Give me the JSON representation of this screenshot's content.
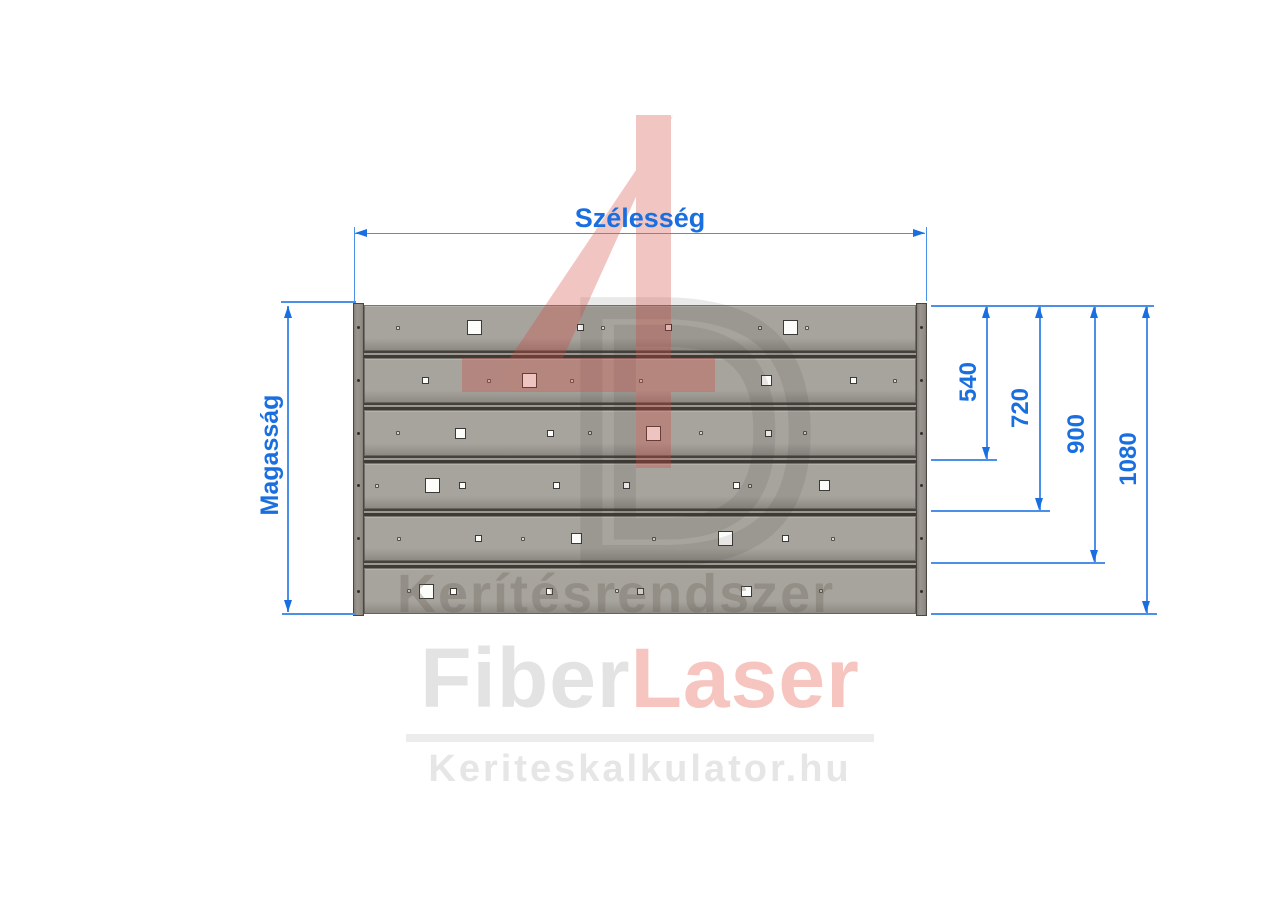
{
  "colors": {
    "dim_text_blue": "#1a6fe0",
    "dim_line_blue": "#4a90ea",
    "board_fill": "#a7a39d",
    "board_highlight": "#b6b2ac",
    "board_shadow": "#8b8781",
    "gap_dark": "#3e3b37",
    "gap_light": "#9d9992",
    "post_dark": "#4a4742",
    "hole_fill": "#fcfcfb",
    "hole_border": "#3c3a36",
    "dot_fill": "#d9d5cf",
    "dot_border": "#55524c",
    "watermark_red": "#d2443a",
    "watermark_gray": "#37342f",
    "watermark_text_gray": "#686258",
    "logo_gray": "#e3e3e3",
    "logo_red": "#f7c5bf",
    "logo_divider": "#ececec",
    "logo_url": "#e6e6e6"
  },
  "dimensions": {
    "width_label": "Szélesség",
    "height_label": "Magasság",
    "right": [
      {
        "label": "540",
        "x": 987,
        "bottom": 459,
        "label_cx": 969,
        "label_cy": 382
      },
      {
        "label": "720",
        "x": 1040,
        "bottom": 510,
        "label_cx": 1021,
        "label_cy": 408
      },
      {
        "label": "900",
        "x": 1095,
        "bottom": 562,
        "label_cx": 1077,
        "label_cy": 434
      },
      {
        "label": "1080",
        "x": 1147,
        "bottom": 613,
        "label_cx": 1129,
        "label_cy": 459
      }
    ]
  },
  "watermark": {
    "numeral": "4",
    "letter": "D",
    "text": "Kerítésrendszer"
  },
  "footer": {
    "brand_part1": "Fiber",
    "brand_part2": "Laser",
    "website": "Keriteskalkulator.hu"
  },
  "panel": {
    "board_count": 6,
    "holes": [
      {
        "r": 1,
        "x": 398,
        "s": "dot"
      },
      {
        "r": 1,
        "x": 474,
        "s": "lg"
      },
      {
        "r": 1,
        "x": 580,
        "s": "sm"
      },
      {
        "r": 1,
        "x": 603,
        "s": "dot"
      },
      {
        "r": 1,
        "x": 668,
        "s": "sm"
      },
      {
        "r": 1,
        "x": 760,
        "s": "dot"
      },
      {
        "r": 1,
        "x": 790,
        "s": "lg"
      },
      {
        "r": 1,
        "x": 807,
        "s": "dot"
      },
      {
        "r": 2,
        "x": 425,
        "s": "sm"
      },
      {
        "r": 2,
        "x": 489,
        "s": "dot"
      },
      {
        "r": 2,
        "x": 529,
        "s": "lg"
      },
      {
        "r": 2,
        "x": 572,
        "s": "dot"
      },
      {
        "r": 2,
        "x": 641,
        "s": "dot"
      },
      {
        "r": 2,
        "x": 766,
        "s": "md"
      },
      {
        "r": 2,
        "x": 853,
        "s": "sm"
      },
      {
        "r": 2,
        "x": 895,
        "s": "dot"
      },
      {
        "r": 3,
        "x": 398,
        "s": "dot"
      },
      {
        "r": 3,
        "x": 460,
        "s": "md"
      },
      {
        "r": 3,
        "x": 550,
        "s": "sm"
      },
      {
        "r": 3,
        "x": 590,
        "s": "dot"
      },
      {
        "r": 3,
        "x": 653,
        "s": "lg"
      },
      {
        "r": 3,
        "x": 701,
        "s": "dot"
      },
      {
        "r": 3,
        "x": 768,
        "s": "sm"
      },
      {
        "r": 3,
        "x": 805,
        "s": "dot"
      },
      {
        "r": 4,
        "x": 377,
        "s": "dot"
      },
      {
        "r": 4,
        "x": 432,
        "s": "lg"
      },
      {
        "r": 4,
        "x": 462,
        "s": "sm"
      },
      {
        "r": 4,
        "x": 556,
        "s": "sm"
      },
      {
        "r": 4,
        "x": 626,
        "s": "sm"
      },
      {
        "r": 4,
        "x": 736,
        "s": "sm"
      },
      {
        "r": 4,
        "x": 750,
        "s": "dot"
      },
      {
        "r": 4,
        "x": 824,
        "s": "md"
      },
      {
        "r": 5,
        "x": 399,
        "s": "dot"
      },
      {
        "r": 5,
        "x": 478,
        "s": "sm"
      },
      {
        "r": 5,
        "x": 523,
        "s": "dot"
      },
      {
        "r": 5,
        "x": 576,
        "s": "md"
      },
      {
        "r": 5,
        "x": 654,
        "s": "dot"
      },
      {
        "r": 5,
        "x": 725,
        "s": "lg"
      },
      {
        "r": 5,
        "x": 785,
        "s": "sm"
      },
      {
        "r": 5,
        "x": 833,
        "s": "dot"
      },
      {
        "r": 6,
        "x": 409,
        "s": "dot"
      },
      {
        "r": 6,
        "x": 426,
        "s": "lg"
      },
      {
        "r": 6,
        "x": 453,
        "s": "sm"
      },
      {
        "r": 6,
        "x": 549,
        "s": "sm"
      },
      {
        "r": 6,
        "x": 617,
        "s": "dot"
      },
      {
        "r": 6,
        "x": 640,
        "s": "sm"
      },
      {
        "r": 6,
        "x": 746,
        "s": "md"
      },
      {
        "r": 6,
        "x": 821,
        "s": "dot"
      }
    ]
  }
}
